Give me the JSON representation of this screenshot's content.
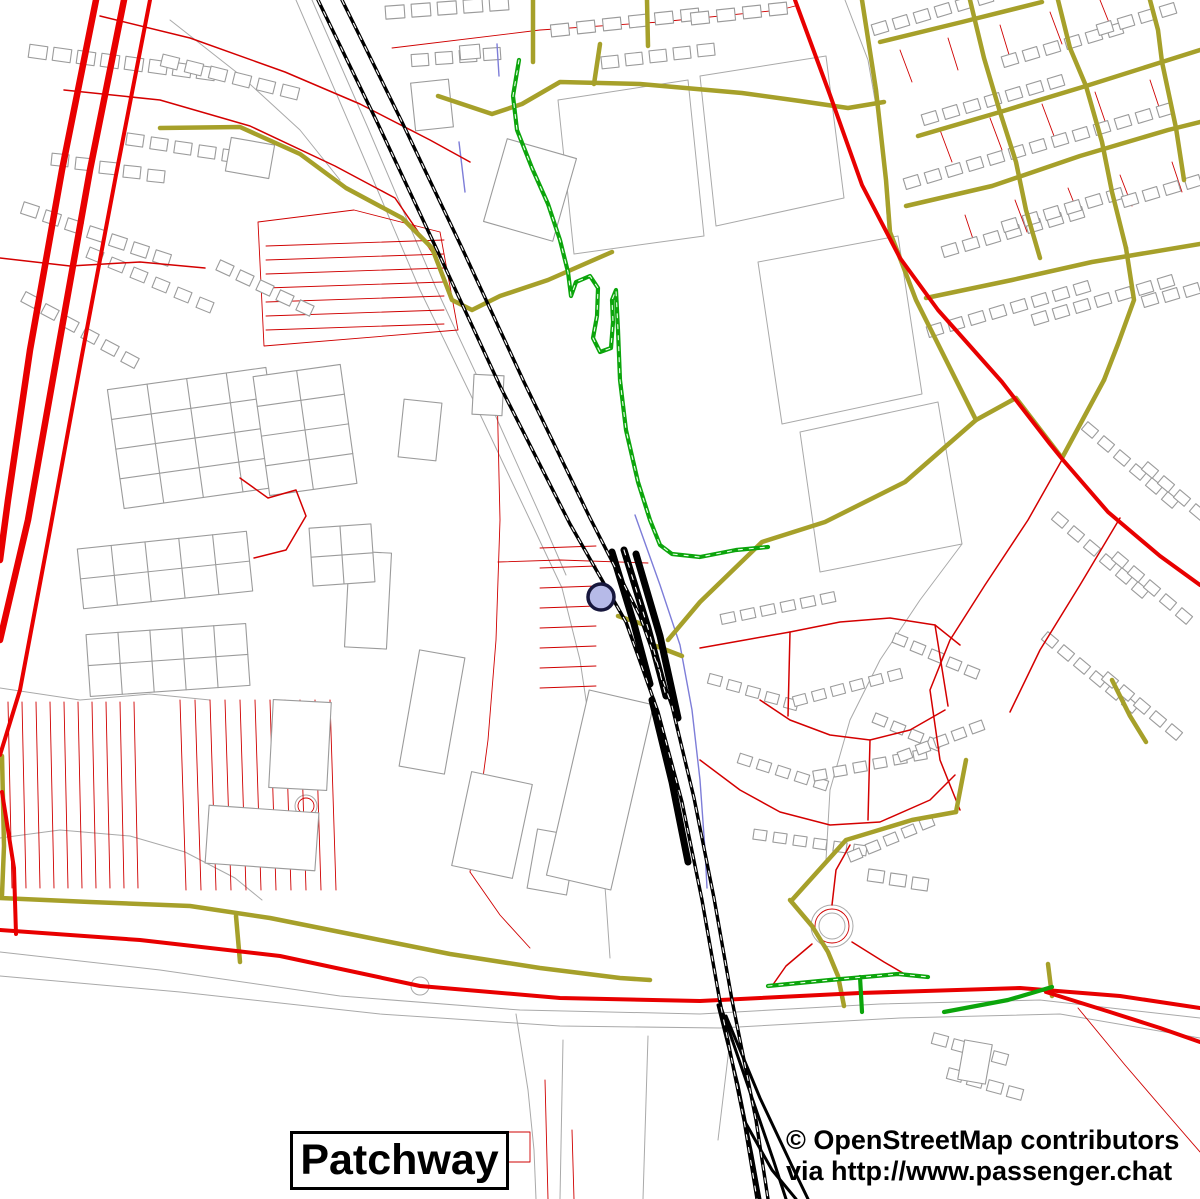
{
  "labels": {
    "place_name": "Patchway",
    "attribution_line1": "© OpenStreetMap contributors",
    "attribution_line2": "via http://www.passenger.chat"
  },
  "legend_colors": {
    "motorway_red": "#e80000",
    "secondary_olive": "#a6a02a",
    "footpath_green": "#0ca50c",
    "railway_black": "#000000",
    "building_gray": "#9b9b9b",
    "parcel_red": "#cf0000",
    "stream_blue": "#7d7dd8",
    "marker_fill": "#b6bae8",
    "marker_ring": "#17173d"
  },
  "map": {
    "layers": [
      {
        "name": "boundary-gray-lines",
        "stroke": "#a9a9a9",
        "width": 1,
        "lines": [
          "296,0 352,130 420,290 478,410 530,520 562,588 580,660 592,740 600,820 606,900 610,958",
          "312,0 368,128 436,288 492,408 540,515 566,575",
          "558,100 688,80 704,236 574,254 558,100",
          "700,76 826,56 844,198 716,226 700,76",
          "758,262 898,236 922,394 782,424 758,262",
          "800,432 938,402 962,544 820,572 800,432",
          "962,544 920,600 880,660 850,720 830,790 826,860",
          "0,952 160,970 340,996 520,1010 700,1014 880,1004 1040,1000 1200,1018",
          "0,976 180,992 380,1014 560,1026 720,1028 900,1018 1060,1014 1200,1038",
          "516,1014 528,1090 534,1150 536,1199",
          "170,20 240,75 300,130 340,180",
          "0,688 80,700 150,694 210,700",
          "0,838 60,830 130,836 185,852 235,878 262,900",
          "563,1040 560,1199",
          "648,1036 643,1199",
          "730,1040 718,1140",
          "845,0 868,60 882,140 888,230"
        ],
        "circles": [
          [
            832,
            926,
            21
          ],
          [
            832,
            926,
            13
          ],
          [
            420,
            986,
            9
          ],
          [
            306,
            806,
            11
          ]
        ]
      },
      {
        "name": "parcel-red-lines",
        "stroke": "#cf0000",
        "width": 0.9,
        "lines": [
          "258,222 354,210 440,232 458,330 264,346 258,222",
          "497,388 500,520 496,640 488,740 476,830 470,872",
          "498,562 560,560 648,563",
          "470,872 500,915 530,948",
          "392,48 540,30 660,22 780,10 795,6",
          "900,50 912,82",
          "948,38 958,70",
          "1000,25 1010,58",
          "1050,12 1062,44",
          "1100,0 1112,30",
          "940,130 952,162",
          "990,118 1002,150",
          "1042,104 1054,136",
          "1095,92 1106,124",
          "1150,80 1160,110",
          "965,215 975,245",
          "1015,200 1027,232",
          "1068,188 1080,218",
          "1120,175 1132,206",
          "1172,162 1182,192",
          "545,1080 548,1199",
          "572,1130 574,1199",
          "508,1132 530,1132 530,1162 508,1162 508,1132",
          "1078,1008 1125,1065 1168,1115 1200,1152"
        ],
        "combs": [
          [
            266,
            246,
            0,
            14,
            7,
            178,
            -6
          ],
          [
            8,
            702,
            14,
            0,
            10,
            4,
            186
          ],
          [
            180,
            700,
            15,
            0,
            11,
            6,
            190
          ],
          [
            540,
            548,
            0,
            20,
            8,
            56,
            -2
          ]
        ],
        "circles": [
          [
            832,
            926,
            17
          ],
          [
            306,
            806,
            8
          ]
        ]
      },
      {
        "name": "building-footprints",
        "stroke": "#9b9b9b",
        "width": 1.1,
        "fill": "#ffffff",
        "rows": [
          [
            38,
            52,
            24,
            3,
            8,
            18,
            13,
            8
          ],
          [
            170,
            62,
            24,
            6,
            6,
            17,
            12,
            14
          ],
          [
            135,
            140,
            24,
            4,
            5,
            17,
            12,
            8
          ],
          [
            60,
            160,
            24,
            4,
            5,
            17,
            12,
            6
          ],
          [
            30,
            210,
            22,
            8,
            7,
            16,
            12,
            18
          ],
          [
            95,
            255,
            22,
            10,
            6,
            15,
            11,
            22
          ],
          [
            225,
            268,
            20,
            10,
            5,
            15,
            11,
            25
          ],
          [
            30,
            300,
            20,
            12,
            6,
            15,
            11,
            28
          ],
          [
            395,
            12,
            26,
            -2,
            5,
            19,
            13,
            -4
          ],
          [
            560,
            30,
            26,
            -3,
            6,
            18,
            12,
            -6
          ],
          [
            700,
            18,
            26,
            -3,
            4,
            18,
            12,
            -6
          ],
          [
            420,
            60,
            24,
            -2,
            4,
            17,
            12,
            -4
          ],
          [
            610,
            62,
            24,
            -3,
            5,
            17,
            12,
            -6
          ],
          [
            880,
            28,
            21,
            -6,
            6,
            15,
            11,
            -17
          ],
          [
            930,
            118,
            21,
            -6,
            7,
            15,
            11,
            -17
          ],
          [
            912,
            182,
            21,
            -6,
            7,
            15,
            11,
            -17
          ],
          [
            950,
            250,
            21,
            -6,
            7,
            15,
            11,
            -17
          ],
          [
            1010,
            60,
            21,
            -6,
            6,
            15,
            11,
            -17
          ],
          [
            1060,
            140,
            21,
            -6,
            6,
            15,
            11,
            -17
          ],
          [
            1010,
            225,
            21,
            -6,
            6,
            15,
            11,
            -17
          ],
          [
            1105,
            28,
            21,
            -6,
            4,
            15,
            11,
            -17
          ],
          [
            1130,
            200,
            21,
            -6,
            4,
            15,
            11,
            -17
          ],
          [
            935,
            330,
            21,
            -6,
            8,
            15,
            11,
            -17
          ],
          [
            1040,
            318,
            21,
            -6,
            7,
            15,
            11,
            -17
          ],
          [
            1150,
            300,
            21,
            -5,
            3,
            15,
            11,
            -17
          ],
          [
            1090,
            430,
            16,
            14,
            6,
            14,
            10,
            40
          ],
          [
            1150,
            470,
            16,
            14,
            4,
            14,
            10,
            40
          ],
          [
            1060,
            520,
            16,
            14,
            6,
            14,
            10,
            40
          ],
          [
            1120,
            560,
            16,
            14,
            5,
            14,
            10,
            40
          ],
          [
            1050,
            640,
            16,
            13,
            6,
            14,
            10,
            40
          ],
          [
            1110,
            680,
            16,
            13,
            5,
            14,
            10,
            40
          ],
          [
            728,
            618,
            20,
            -4,
            6,
            14,
            10,
            -12
          ],
          [
            715,
            680,
            19,
            6,
            5,
            13,
            10,
            15
          ],
          [
            800,
            700,
            19,
            -5,
            6,
            13,
            10,
            -15
          ],
          [
            745,
            760,
            19,
            6,
            5,
            13,
            10,
            18
          ],
          [
            820,
            775,
            20,
            -4,
            6,
            13,
            10,
            -10
          ],
          [
            900,
            640,
            18,
            8,
            5,
            13,
            10,
            22
          ],
          [
            880,
            720,
            18,
            8,
            4,
            13,
            10,
            22
          ],
          [
            905,
            755,
            18,
            -7,
            5,
            13,
            10,
            -20
          ],
          [
            760,
            835,
            20,
            3,
            6,
            13,
            10,
            8
          ],
          [
            855,
            855,
            18,
            -8,
            5,
            13,
            10,
            -22
          ],
          [
            940,
            1040,
            20,
            6,
            4,
            15,
            11,
            15
          ],
          [
            955,
            1075,
            20,
            6,
            4,
            15,
            11,
            15
          ],
          [
            876,
            876,
            22,
            4,
            3,
            16,
            12,
            8
          ]
        ],
        "rects": [
          [
            432,
            105,
            38,
            48,
            -6
          ],
          [
            530,
            190,
            72,
            86,
            16
          ],
          [
            470,
            52,
            20,
            14,
            -5
          ],
          [
            250,
            158,
            44,
            34,
            10
          ],
          [
            300,
            745,
            58,
            88,
            3
          ],
          [
            432,
            712,
            46,
            118,
            10
          ],
          [
            262,
            838,
            110,
            58,
            4
          ],
          [
            492,
            825,
            62,
            96,
            12
          ],
          [
            552,
            862,
            40,
            60,
            10
          ],
          [
            368,
            600,
            42,
            96,
            3
          ],
          [
            420,
            430,
            38,
            58,
            6
          ],
          [
            488,
            395,
            30,
            40,
            3
          ],
          [
            600,
            790,
            66,
            190,
            13
          ],
          [
            975,
            1062,
            28,
            40,
            10
          ]
        ]
      },
      {
        "name": "glasshouse-grids",
        "stroke": "#9b9b9b",
        "width": 1.1,
        "fill": "#ffffff",
        "grids": [
          [
            195,
            438,
            160,
            120,
            4,
            4,
            -8
          ],
          [
            305,
            430,
            88,
            120,
            2,
            4,
            -8
          ],
          [
            165,
            570,
            170,
            60,
            5,
            2,
            -6
          ],
          [
            168,
            660,
            160,
            62,
            5,
            2,
            -4
          ],
          [
            342,
            555,
            62,
            58,
            2,
            2,
            -4
          ]
        ]
      },
      {
        "name": "stream-blue",
        "stroke": "#7d7dd8",
        "width": 1.4,
        "lines": [
          "497,44 499,76",
          "459,142 465,192",
          "635,515 660,585 680,645 692,710 700,780 705,850 707,888"
        ]
      },
      {
        "name": "roads-residential-red",
        "stroke": "#d40000",
        "width": 1.5,
        "lines": [
          "64,90 160,100 250,126 335,166 395,198 432,252",
          "100,16 190,38 285,72 360,104 430,140 470,162",
          "0,258 70,266 140,262 205,268",
          "240,478 268,498 296,490 306,516 286,550 254,558",
          "700,648 745,640 790,632 840,622 890,618 935,625 960,645",
          "760,700 790,720 830,735 870,740 910,730 945,710",
          "700,760 740,790 780,812 830,825 880,822 930,800 955,775",
          "790,632 788,716",
          "870,740 868,820",
          "935,625 948,706",
          "1063,458 1028,520 985,585 950,640 930,690 940,760 960,810",
          "1120,518 1080,585 1040,650 1010,712",
          "832,905 836,870 850,845",
          "812,944 786,966 772,986",
          "852,942 884,962 908,976"
        ]
      },
      {
        "name": "roads-secondary-olive",
        "stroke": "#a6a02a",
        "width": 4.5,
        "lines": [
          "160,128 240,127 300,154 346,188 402,218 432,248 452,300 472,310 500,296 548,280 612,252",
          "438,96 492,114 522,104 560,82 640,84 742,93 800,101 848,108 884,102",
          "533,0 533,62",
          "594,84 600,44",
          "647,0 648,46",
          "862,0 876,90 886,180 890,232 916,300 950,368 976,420",
          "976,420 905,482 825,522 762,542 700,602 668,640",
          "976,420 1016,398 1062,458",
          "1104,380 1062,458",
          "880,42 962,22 1042,2",
          "918,136 1000,112 1086,86 1162,62 1200,50",
          "906,206 992,186 1080,156 1168,130 1200,122",
          "926,298 1012,280 1092,262 1200,244",
          "970,0 984,58 1000,112",
          "1058,0 1070,48 1086,86",
          "1086,86 1102,142 1112,192 1126,248",
          "1000,112 1016,162 1026,210 1040,258",
          "1150,0 1158,30 1162,62",
          "1162,62 1176,128 1184,180",
          "1126,248 1134,300 1118,344 1104,380",
          "0,898 90,902 190,906 270,918 360,936 450,954 540,968 620,978 650,980",
          "2,756 4,846 2,895",
          "236,916 240,962",
          "790,900 812,926 828,952 838,976 844,1006",
          "792,900 846,840 912,820 956,812",
          "956,812 966,760",
          "1048,964 1052,996",
          "1112,680 1130,716 1146,742",
          "618,616 642,624",
          "656,646 682,656"
        ]
      },
      {
        "name": "roads-primary-red",
        "stroke": "#e80000",
        "width": 4,
        "lines": [
          "795,0 830,95 862,185 900,258 938,310 1002,382 1050,444 1063,460 1108,512 1160,556 1200,585",
          "0,930 140,940 280,956 420,986 560,998 700,1001 860,993 1020,988 1120,996 1200,1008",
          "1046,992 1110,1012 1160,1028 1200,1042",
          "2,792 14,868 16,934"
        ]
      },
      {
        "name": "motorway-red",
        "stroke": "#e80000",
        "width": 6.5,
        "lines": [
          "96,0 62,170 30,350 8,500 0,560",
          "124,0 90,170 58,350 28,520 0,640"
        ]
      },
      {
        "name": "motorway-red-slip",
        "stroke": "#e80000",
        "width": 4,
        "lines": [
          "150,0 116,175 82,355 50,530 20,690 0,755"
        ]
      },
      {
        "name": "footpaths-green",
        "stroke": "#0ca50c",
        "width": 4.2,
        "lines": [
          "519,60 513,96 517,130 532,168 548,204 560,240 568,272 571,296 576,282 590,276 598,288 597,316 593,338 600,352 611,348 613,322 612,300 616,290 618,330 620,380 626,430 638,482 650,520 660,545 672,554 700,557 736,550 768,547",
          "768,986 830,980 898,974 928,977",
          "860,977 862,1012",
          "944,1012 1008,1000 1052,987"
        ]
      },
      {
        "name": "footpaths-green-dash",
        "stroke": "#e9ffe9",
        "width": 1.1,
        "dash": "4,7",
        "lines": [
          "519,60 513,96 517,130 532,168 548,204 560,240 568,272 571,296 576,282 590,276 598,288 597,316 593,338 600,352 611,348 613,322 612,300 616,290 618,330 620,380 626,430 638,482 650,520 660,545 672,554 700,557 736,550 768,547",
          "768,986 830,980 898,974 928,977"
        ]
      },
      {
        "name": "railway-tracks",
        "stroke": "#000000",
        "width": 3.4,
        "lines": [
          "318,0 378,124 438,252 500,386 570,524 626,622 658,712 682,802 702,900 720,1002 744,1120 757,1199",
          "342,0 402,122 462,248 524,382 590,518 640,616 672,706 694,798 714,898 732,1000 756,1120 768,1199"
        ]
      },
      {
        "name": "railway-sidings",
        "stroke": "#000000",
        "width": 7,
        "lines": [
          "612,552 634,624 650,684",
          "624,550 648,628 666,696",
          "636,554 660,636 678,718",
          "652,700 672,782 688,862"
        ]
      },
      {
        "name": "railway-junction-fan",
        "stroke": "#000000",
        "width": 3,
        "lines": [
          "718,1005 738,1085 752,1155 760,1199",
          "722,1010 750,1092 774,1162 786,1199",
          "726,1016 760,1098 792,1166 808,1199",
          "744,1120 772,1170 796,1199"
        ]
      },
      {
        "name": "railway-centerline-dash",
        "stroke": "#ffffff",
        "width": 1.1,
        "dash": "5,8",
        "lines": [
          "318,0 378,124 438,252 500,386 570,524 626,622 658,712 682,802 702,900 720,1002 744,1120 757,1199",
          "342,0 402,122 462,248 524,382 590,518 640,616 672,706 694,798 714,898 732,1000 756,1120 768,1199",
          "624,550 648,628 666,696"
        ]
      },
      {
        "name": "station-marker",
        "stroke": "#17173d",
        "width": 3.5,
        "fill": "#b6bae8",
        "interactable": true,
        "circles": [
          [
            601,
            597,
            13
          ]
        ]
      }
    ]
  }
}
